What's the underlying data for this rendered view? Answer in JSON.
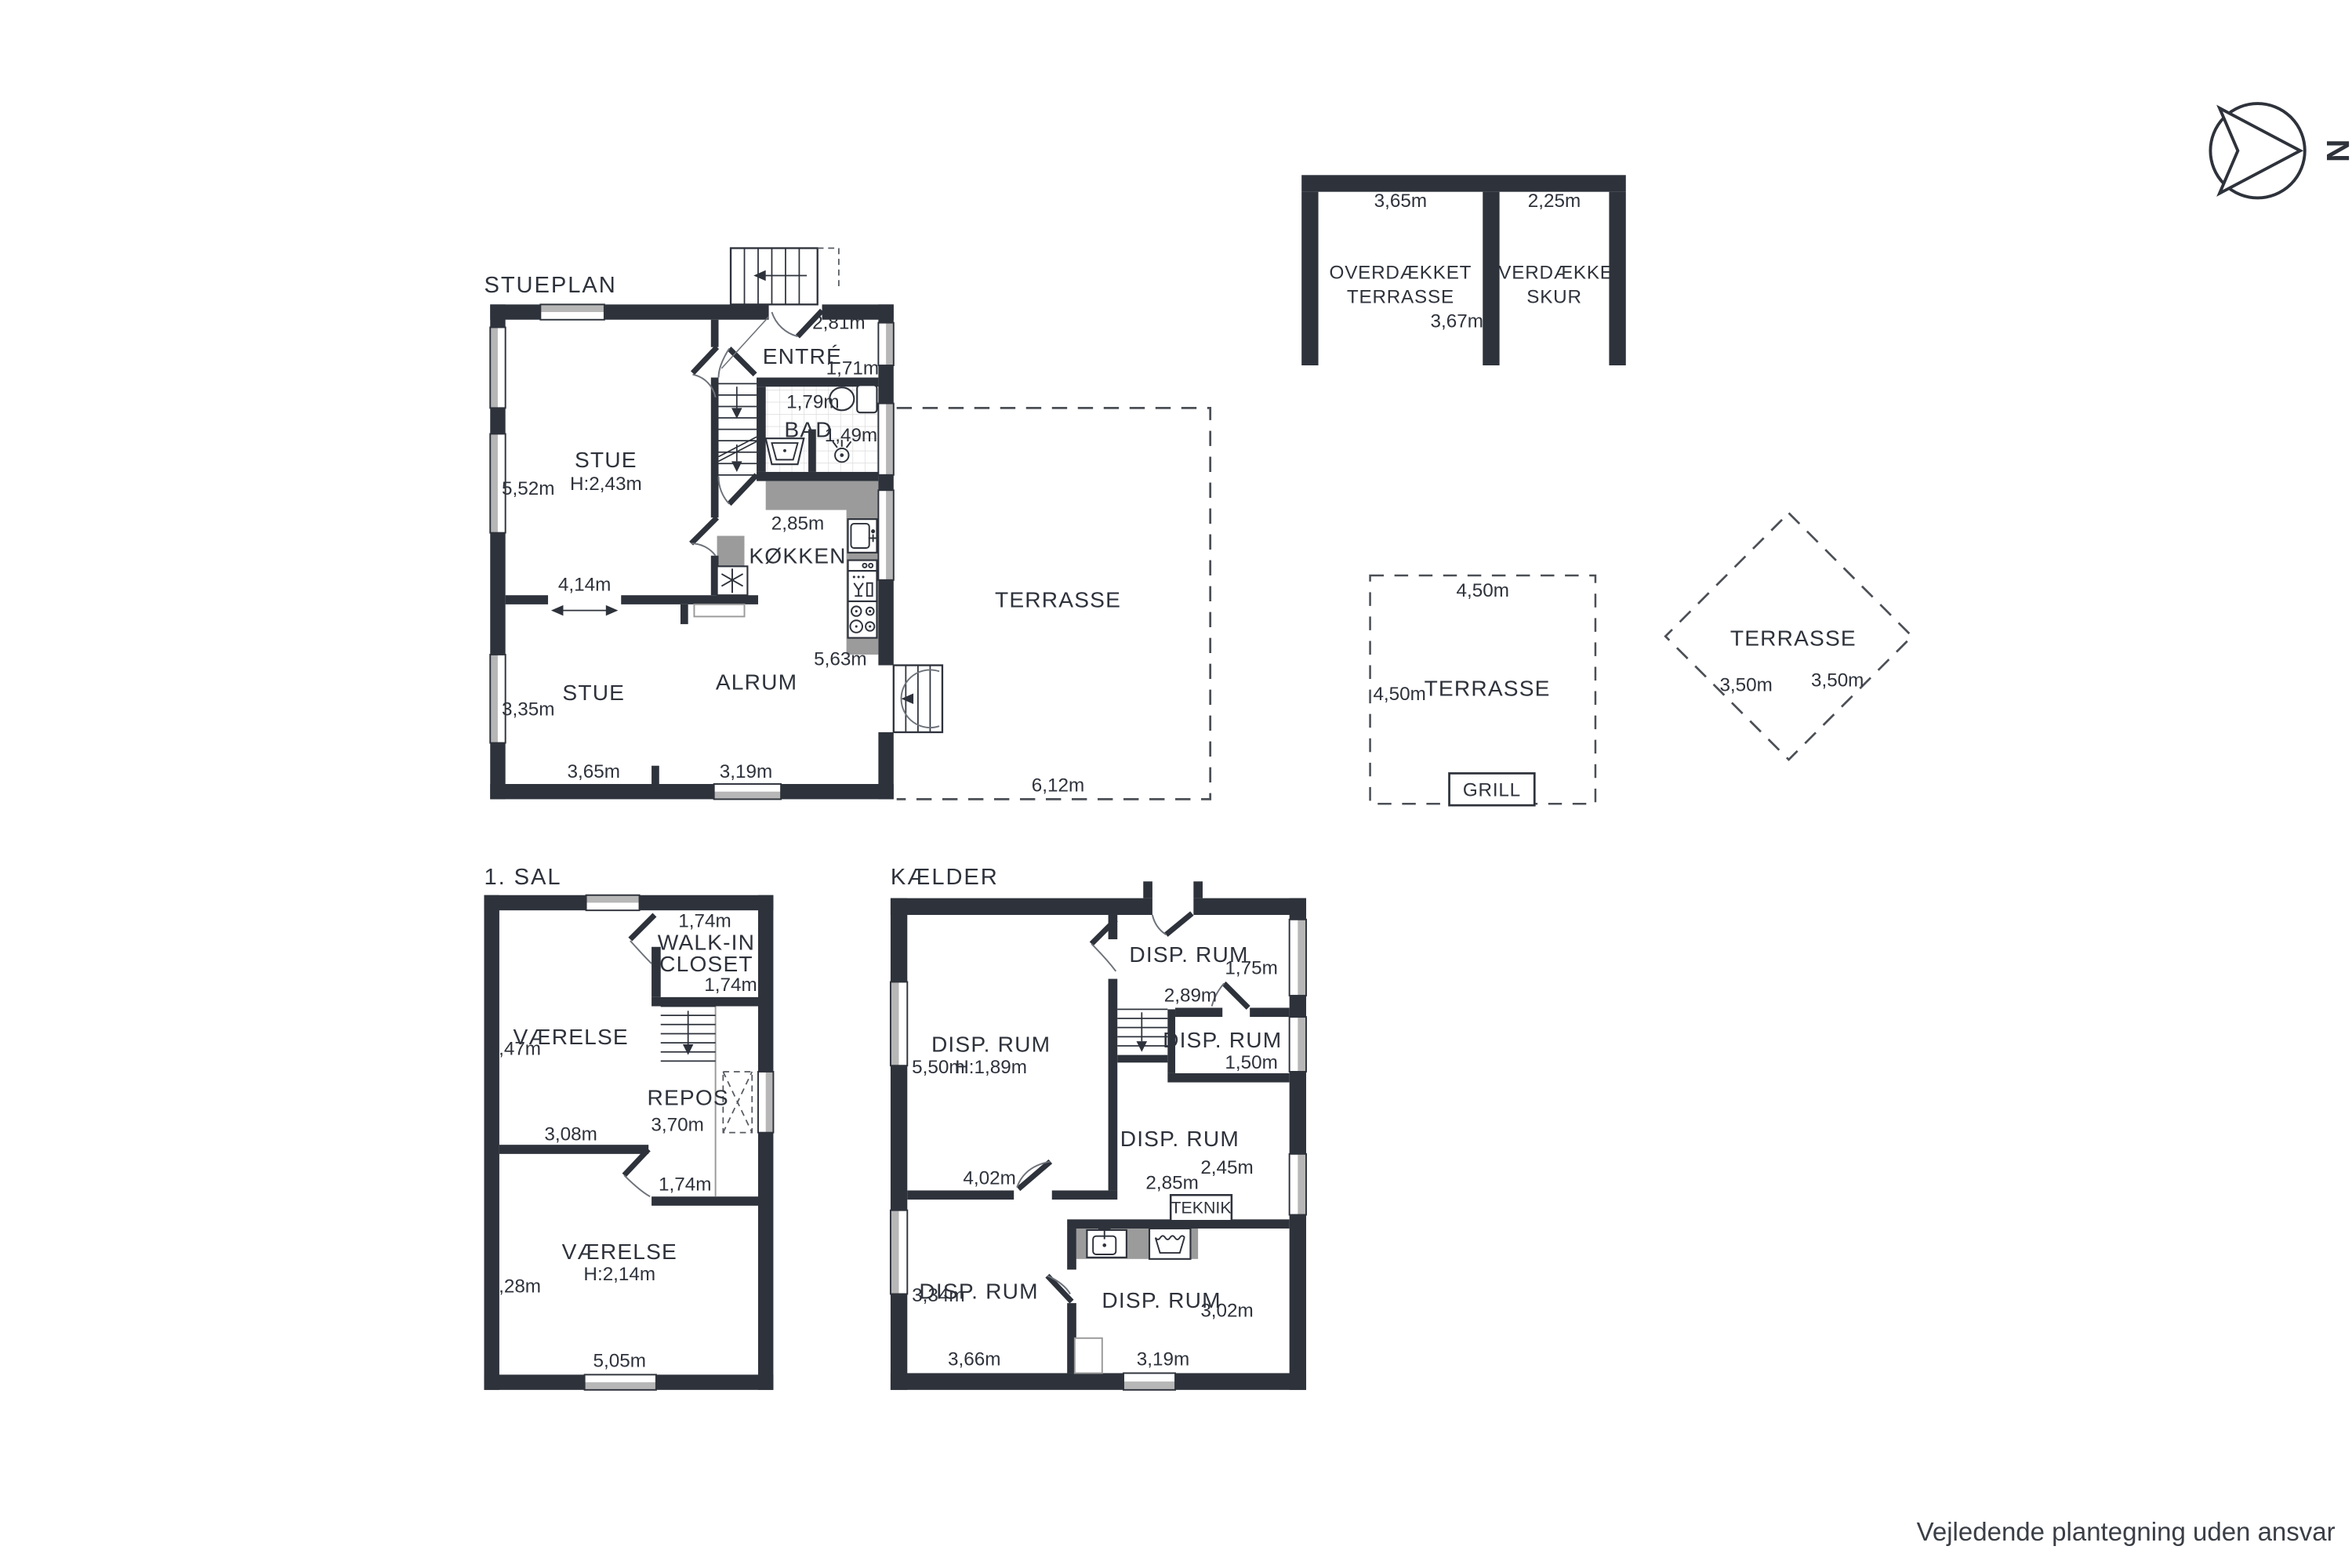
{
  "meta": {
    "disclaimer": "Vejledende plantegning uden ansvar"
  },
  "compass": {
    "north": "N"
  },
  "stueplan": {
    "label": "STUEPLAN",
    "entre": {
      "name": "ENTRÉ",
      "dim_top": "2,81m",
      "dim_right": "1,71m"
    },
    "bad": {
      "name": "BAD",
      "dim_top": "1,79m",
      "dim_right": "1,49m"
    },
    "stue_upper": {
      "name": "STUE",
      "ceiling": "H:2,43m",
      "dim_left": "5,52m"
    },
    "koekken": {
      "name": "KØKKEN",
      "dim_top": "2,85m",
      "dim_right": "5,63m"
    },
    "opening_dim": "4,14m",
    "stue_lower": {
      "name": "STUE",
      "dim_left": "3,35m",
      "dim_bottom": "3,65m"
    },
    "alrum": {
      "name": "ALRUM",
      "dim_bottom": "3,19m"
    },
    "terrasse": {
      "name": "TERRASSE",
      "dim_bottom": "6,12m"
    }
  },
  "overdaekket_terrasse": {
    "line1": "OVERDÆKKET",
    "line2": "TERRASSE",
    "dim_top": "3,65m",
    "dim_inner": "3,67m"
  },
  "overdaekket_skur": {
    "line1": "OVERDÆKKET",
    "line2": "SKUR",
    "dim_top": "2,25m"
  },
  "terrasse_grill": {
    "name": "TERRASSE",
    "dim_top": "4,50m",
    "dim_left": "4,50m",
    "grill": "GRILL"
  },
  "terrasse_diamond": {
    "name": "TERRASSE",
    "dim_a": "3,50m",
    "dim_b": "3,50m"
  },
  "sal1": {
    "label": "1. SAL",
    "walkin": {
      "line1": "WALK-IN",
      "line2": "CLOSET",
      "dim_top": "1,74m",
      "dim_bottom": "1,74m"
    },
    "vaerelse_upper": {
      "name": "VÆRELSE",
      "dim_left": "4,47m",
      "dim_bottom": "3,08m"
    },
    "repos": {
      "name": "REPOS",
      "dim": "3,70m"
    },
    "hall_dim": "1,74m",
    "vaerelse_lower": {
      "name": "VÆRELSE",
      "ceiling": "H:2,14m",
      "dim_left": "4,28m",
      "dim_bottom": "5,05m"
    }
  },
  "kaelder": {
    "label": "KÆLDER",
    "disp_main": {
      "name": "DISP. RUM",
      "ceiling": "H:1,89m",
      "dim_left": "5,50m"
    },
    "disp_topright": {
      "name": "DISP. RUM",
      "dim": "1,75m"
    },
    "hall_dim": "2,89m",
    "disp_midright": {
      "name": "DISP. RUM",
      "dim": "1,50m"
    },
    "disp_right": {
      "name": "DISP. RUM",
      "dim": "2,45m",
      "dim2": "2,85m"
    },
    "teknik": "TEKNIK",
    "disp_bottomleft": {
      "name": "DISP. RUM",
      "dim_left": "3,34m",
      "dim_bottom": "3,66m",
      "dim_top": "4,02m"
    },
    "disp_bottomright": {
      "name": "DISP. RUM",
      "dim_right": "3,02m",
      "dim_bottom": "3,19m"
    }
  }
}
